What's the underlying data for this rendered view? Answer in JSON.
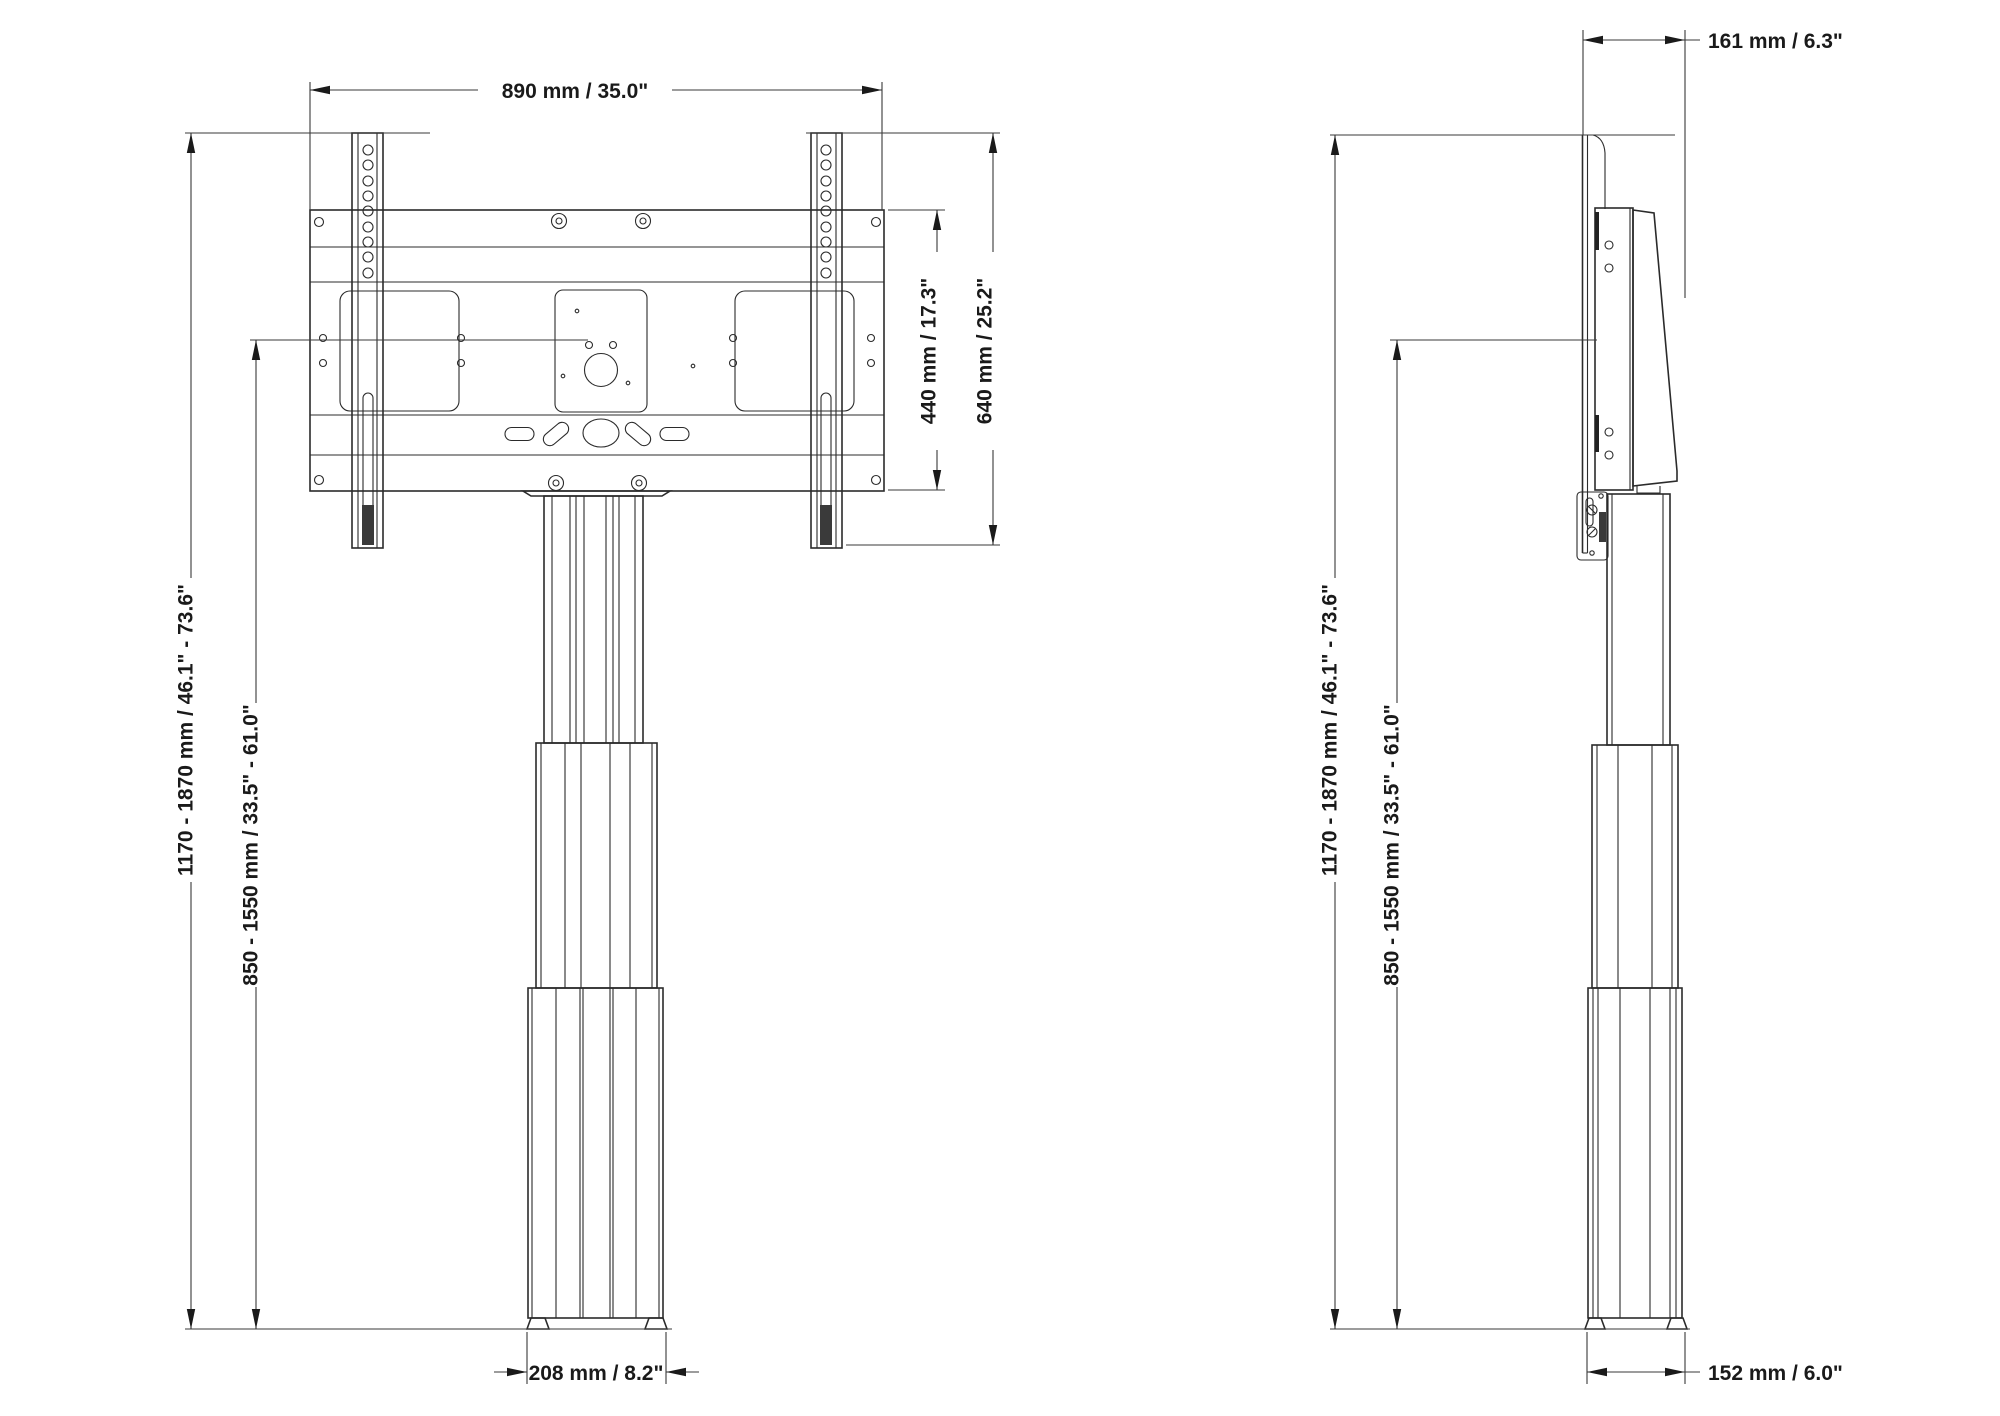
{
  "drawing": {
    "background_color": "#ffffff",
    "line_color": "#2b2b2b",
    "dimensions": {
      "mount_width": "890 mm / 35.0\"",
      "plate_height": "440 mm / 17.3\"",
      "bracket_height": "640 mm / 25.2\"",
      "overall_height_range": "1170 - 1870 mm / 46.1\" - 73.6\"",
      "center_height_range": "850 - 1550 mm / 33.5\" - 61.0\"",
      "base_width": "208 mm / 8.2\"",
      "depth": "161 mm / 6.3\"",
      "base_depth": "152 mm / 6.0\""
    }
  }
}
